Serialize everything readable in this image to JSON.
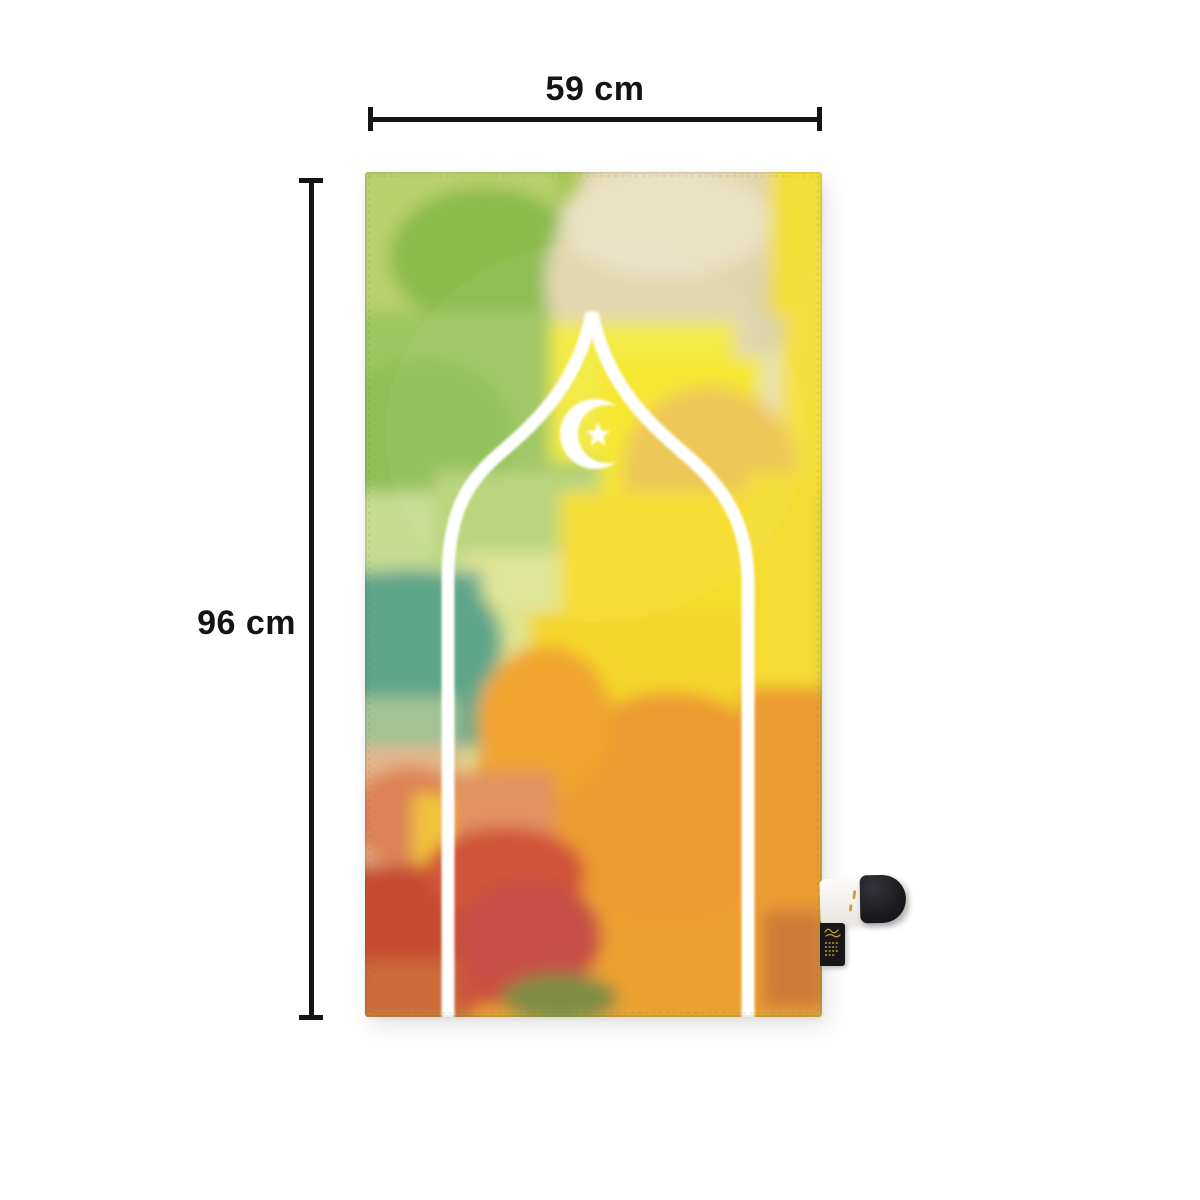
{
  "scene": {
    "background_color": "#ffffff",
    "description": "Product photo of a watercolor travel prayer mat with width and height dimension annotations"
  },
  "annotations": {
    "width": {
      "label": "59 cm"
    },
    "height": {
      "label": "96 cm"
    },
    "line_color": "#141414",
    "text_color": "#141414"
  },
  "mat": {
    "motifs": [
      "mihrab-arch-outline",
      "crescent-and-star"
    ],
    "outline_color": "#ffffff",
    "palette": {
      "lime_green": "#a9c757",
      "green": "#8abb4b",
      "pale_green": "#c6db91",
      "beige": "#e0d5ab",
      "cream": "#e9e2c4",
      "bright_yellow": "#f6e626",
      "deep_yellow": "#f4d62c",
      "golden": "#edc54f",
      "amber_orange": "#eda033",
      "teal": "#68a88d",
      "peach": "#e4b58b",
      "salmon": "#dd8355",
      "red": "#c85045",
      "rust": "#cc6a38",
      "olive": "#7f8c44"
    },
    "hang_tag": {
      "strap_color": "#f7f5f2",
      "snap_color": "#1c1c1f",
      "label_color": "#17171a",
      "label_script_color": "#c29a33"
    }
  }
}
